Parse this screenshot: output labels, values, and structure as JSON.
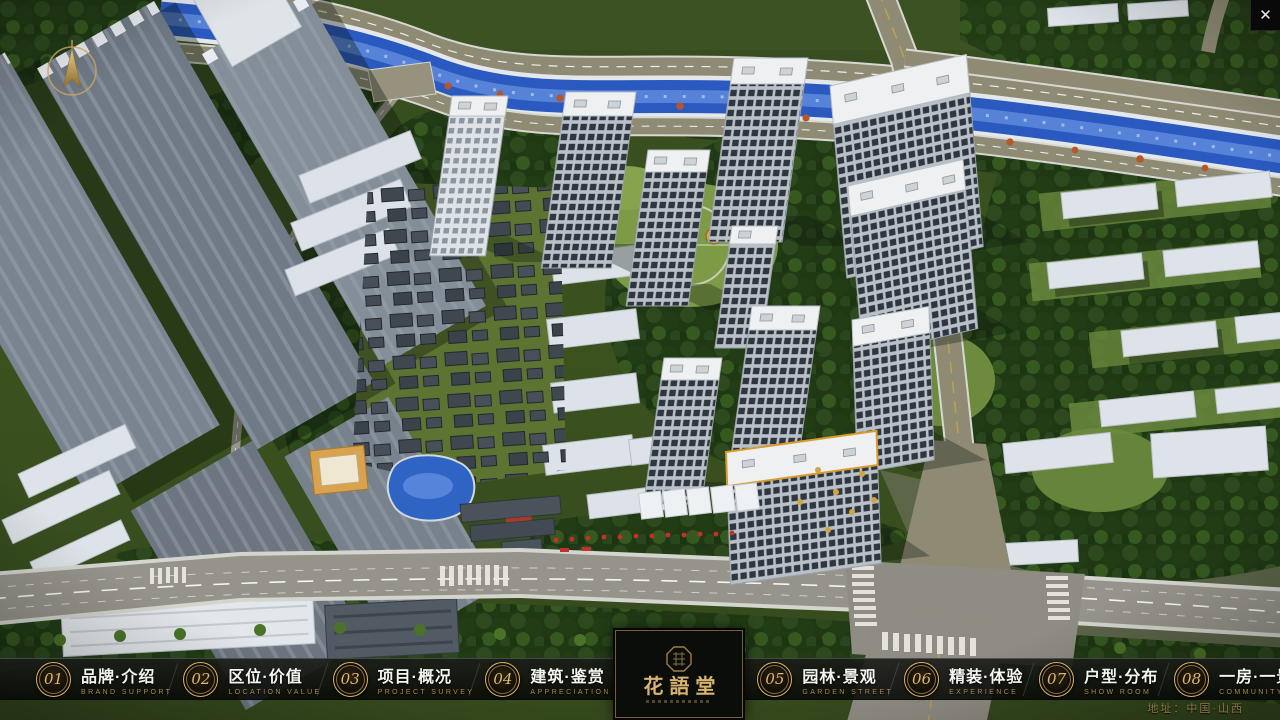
{
  "window": {
    "close_icon": "✕"
  },
  "brand": {
    "logo_title": "花語堂"
  },
  "nav": {
    "items": [
      {
        "num": "01",
        "zh": "品牌·介绍",
        "en": "BRAND SUPPORT"
      },
      {
        "num": "02",
        "zh": "区位·价值",
        "en": "LOCATION VALUE"
      },
      {
        "num": "03",
        "zh": "项目·概况",
        "en": "PROJECT SURVEY"
      },
      {
        "num": "04",
        "zh": "建筑·鉴赏",
        "en": "APPRECIATION"
      },
      {
        "num": "05",
        "zh": "园林·景观",
        "en": "GARDEN STREET"
      },
      {
        "num": "06",
        "zh": "精装·体验",
        "en": "EXPERIENCE"
      },
      {
        "num": "07",
        "zh": "户型·分布",
        "en": "SHOW ROOM"
      },
      {
        "num": "08",
        "zh": "一房·一景",
        "en": "COMMUNITY"
      }
    ]
  },
  "footer": {
    "address": "地址：中国·山西"
  },
  "colors": {
    "brand_gold": "#c8a35f",
    "english_gold": "#ad8d52",
    "address_gold": "#8c7a45",
    "nav_bg": "rgba(10,12,10,0.85)"
  }
}
